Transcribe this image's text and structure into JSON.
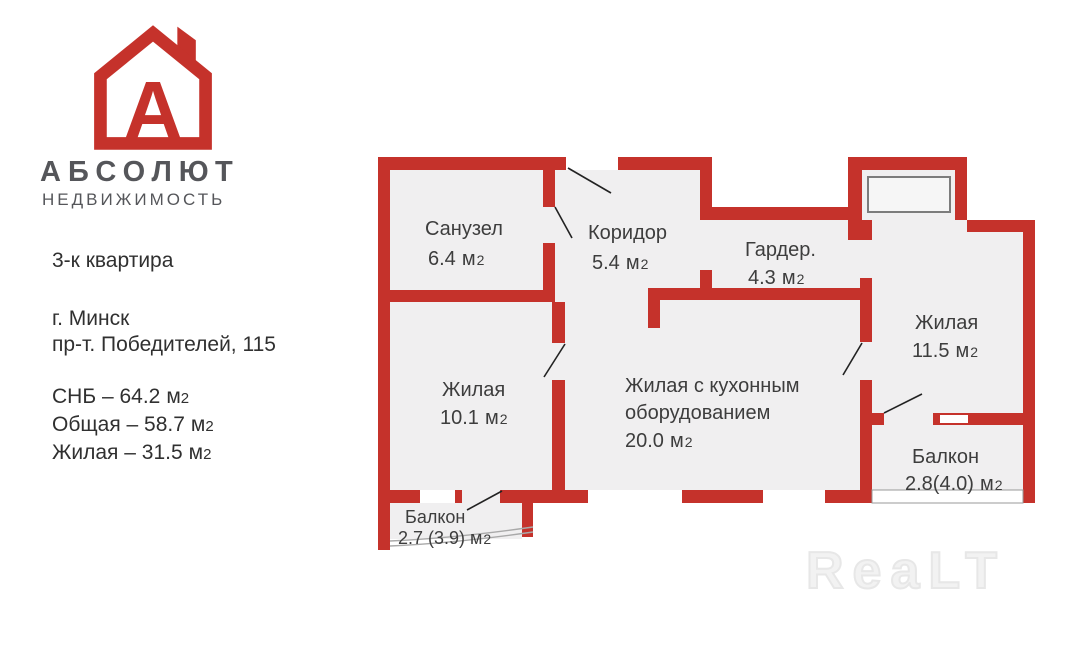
{
  "branding": {
    "logo_letter": "А",
    "company": "АБСОЛЮТ",
    "company_sub": "НЕДВИЖИМОСТЬ"
  },
  "listing": {
    "title": "3-к квартира",
    "city": "г. Минск",
    "address": "пр-т. Победителей, 115",
    "specs": [
      {
        "text": "СНБ – 64.2"
      },
      {
        "text": "Общая –  58.7"
      },
      {
        "text": "Жилая – 31.5"
      }
    ]
  },
  "unit": {
    "m": "м",
    "sup": "2"
  },
  "plan": {
    "rooms": [
      {
        "id": "sanuzel",
        "name": "Санузел",
        "area": "6.4"
      },
      {
        "id": "koridor",
        "name": "Коридор",
        "area": "5.4"
      },
      {
        "id": "garder",
        "name": "Гардер.",
        "area": "4.3"
      },
      {
        "id": "zhilaya-11-5",
        "name": "Жилая",
        "area": "11.5"
      },
      {
        "id": "zhilaya-10-1",
        "name": "Жилая",
        "area": "10.1"
      },
      {
        "id": "kitchen-living",
        "name_line1": "Жилая с кухонным",
        "name_line2": "оборудованием",
        "area": "20.0"
      },
      {
        "id": "balkon-2-8",
        "name": "Балкон",
        "area": "2.8(4.0)"
      },
      {
        "id": "balkon-2-7",
        "name": "Балкон",
        "area": "2.7 (3.9)"
      }
    ]
  },
  "watermark": "ReaLT",
  "colors": {
    "wall_red": "#c5322b",
    "room_fill": "#f0eff0",
    "logo_red": "#c5322b",
    "logo_gray": "#55565a",
    "label_text": "#3d3d3d",
    "window_band_border": "#999999"
  }
}
